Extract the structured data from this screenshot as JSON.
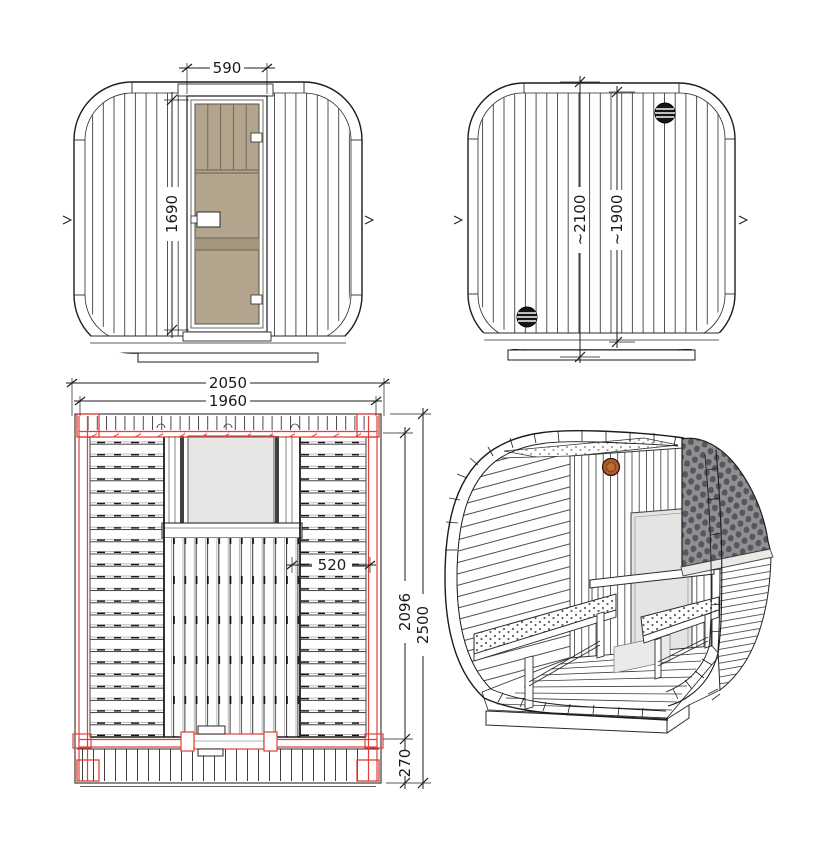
{
  "canvas": {
    "width": 826,
    "height": 850,
    "background": "#ffffff"
  },
  "drawing": {
    "type": "technical-drawing",
    "subject": "cube sauna cabin"
  },
  "colors": {
    "line": "#222222",
    "highlight_red": "#e04038",
    "door_glass": "#b3a48e",
    "door_glass_band": "#a5967e",
    "window_glass": "#e4e4e2",
    "vent_body": "#b2582a",
    "roof_shingle_base": "#8f9093",
    "roof_shingle_dark": "#55575b"
  },
  "views": {
    "front_elevation": {
      "name": "front-elevation",
      "dims": {
        "door_width": "590",
        "door_height": "1690"
      }
    },
    "rear_elevation": {
      "name": "rear-elevation",
      "dims": {
        "overall_height": "~2100",
        "wall_height": "~1900"
      }
    },
    "floor_plan": {
      "name": "floor-plan",
      "dims": {
        "overall_width": "2050",
        "inner_width": "1960",
        "bench_depth": "520",
        "cabin_depth": "2096",
        "overall_depth": "2500",
        "terrace_depth": "270"
      }
    },
    "perspective": {
      "name": "3d-cutaway"
    }
  }
}
